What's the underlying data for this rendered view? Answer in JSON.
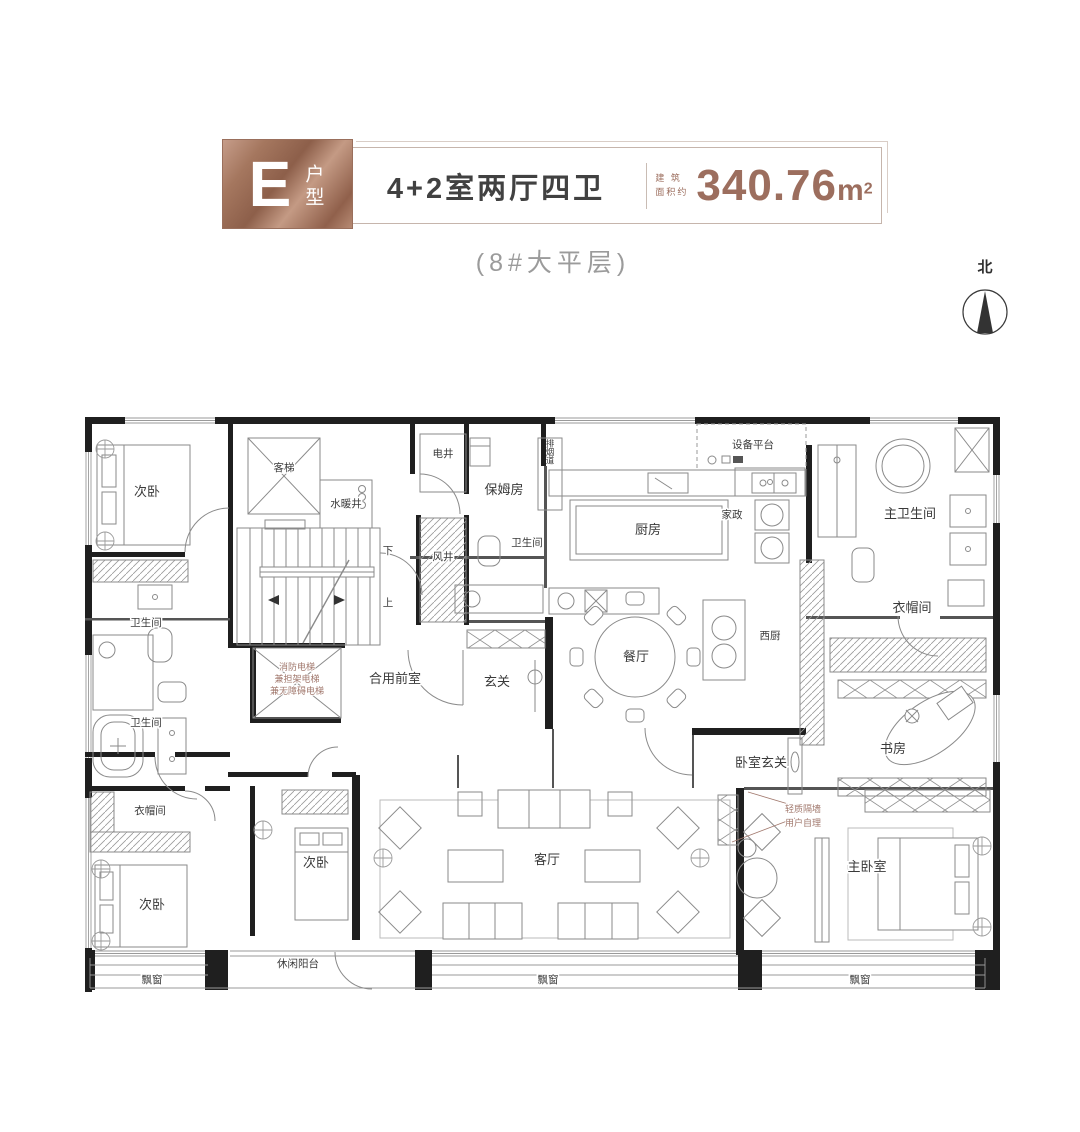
{
  "header": {
    "unit_letter": "E",
    "unit_type": "户型",
    "layout": "4+2室两厅四卫",
    "area_label_line1": "建 筑",
    "area_label_line2": "面积约",
    "area_value": "340.76",
    "area_unit": "m",
    "area_sup": "2",
    "subtitle": "(8#大平层)"
  },
  "compass": {
    "north": "北"
  },
  "rooms": {
    "bedroom_top_left": "次卧",
    "passenger_elevator": "客梯",
    "water_heating_shaft": "水暖井",
    "electric_shaft": "电井",
    "nanny_room": "保姆房",
    "smoke_duct": "排烟道",
    "kitchen": "厨房",
    "housekeeping": "家政",
    "equipment_platform": "设备平台",
    "master_bathroom": "主卫生间",
    "cloakroom_right": "衣帽间",
    "bathroom_top_left": "卫生间",
    "bathroom_mid": "卫生间",
    "air_shaft": "风井",
    "bathroom_left": "卫生间",
    "shared_front_room": "合用前室",
    "foyer": "玄关",
    "dining_room": "餐厅",
    "west_kitchen": "西厨",
    "study": "书房",
    "bedroom_foyer": "卧室玄关",
    "cloakroom_bottom_left": "衣帽间",
    "bedroom_bottom_left": "次卧",
    "bedroom_bottom_mid": "次卧",
    "living_room": "客厅",
    "master_bedroom": "主卧室",
    "leisure_balcony": "休闲阳台",
    "bay_window_left": "飘窗",
    "bay_window_mid": "飘窗",
    "bay_window_right": "飘窗"
  },
  "notes": {
    "elevator_line1": "消防电梯",
    "elevator_line2": "兼担架电梯",
    "elevator_line3": "兼无障碍电梯",
    "partition_line1": "轻质隔墙",
    "partition_line2": "用户自理",
    "stairs_up": "上",
    "stairs_down": "下"
  },
  "colors": {
    "copper": "#a9765f",
    "area_text": "#9c6e5e",
    "note_text": "#a1786d",
    "wall": "#1f1f1f"
  }
}
